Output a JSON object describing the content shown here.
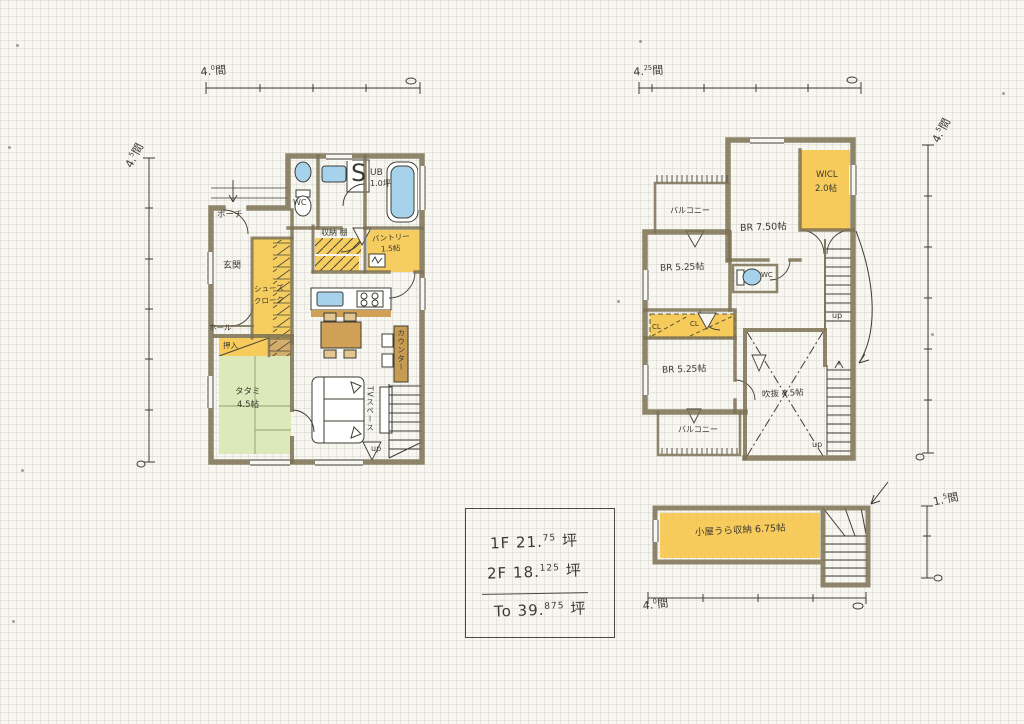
{
  "colors": {
    "paper": "#f7f6f1",
    "ink": "#3e3c33",
    "wall": "#7d7154",
    "highlight_yellow": "#f6c74b",
    "tatami_green": "#dce9bb",
    "fixture_blue": "#a6d2ec",
    "wood_brown": "#cfa055"
  },
  "floor1": {
    "porch": "ポーチ",
    "genkan": "玄関",
    "hall": "ホール",
    "shoes_1": "シューズ",
    "shoes_2": "クローク",
    "oshiire": "押入",
    "tatami_1": "タタミ",
    "tatami_2": "4.5帖",
    "wc": "WC",
    "s_mark": "S",
    "ub_1": "UB",
    "ub_2": "1.0坪",
    "shelf": "収納 棚",
    "pantry_1": "パントリー",
    "pantry_2": "1.5帖",
    "tv_space": "TVスペース",
    "counter": "カウンター",
    "up": "up"
  },
  "floor2": {
    "balcony_top": "バルコニー",
    "br75": "BR 7.50帖",
    "wicl_1": "WICL",
    "wicl_2": "2.0帖",
    "br525a": "BR 5.25帖",
    "wc": "WC",
    "cl_a": "CL",
    "cl_b": "CL",
    "br525b": "BR 5.25帖",
    "void": "吹抜 4.5帖",
    "balcony_bottom": "バルコニー",
    "up_upper": "up",
    "up_lower": "up"
  },
  "attic": {
    "label": "小屋うら収納 6.75帖"
  },
  "dims": {
    "f1_top": {
      "num": "4.",
      "sup": "0",
      "unit": "間"
    },
    "f1_left": {
      "num": "4.",
      "sup": "5",
      "unit": "間"
    },
    "f2_top": {
      "num": "4.",
      "sup": "25",
      "unit": "間"
    },
    "f2_right": {
      "num": "4.",
      "sup": "5",
      "unit": "間"
    },
    "attic_right": {
      "num": "1.",
      "sup": "5",
      "unit": "間"
    },
    "attic_bottom": {
      "num": "4.",
      "sup": "0",
      "unit": "間"
    }
  },
  "summary": {
    "rows": [
      {
        "floor": "1F",
        "num": "21.",
        "sup": "75",
        "unit": "坪"
      },
      {
        "floor": "2F",
        "num": "18.",
        "sup": "125",
        "unit": "坪"
      },
      {
        "floor": "To",
        "num": "39.",
        "sup": "875",
        "unit": "坪"
      }
    ]
  }
}
